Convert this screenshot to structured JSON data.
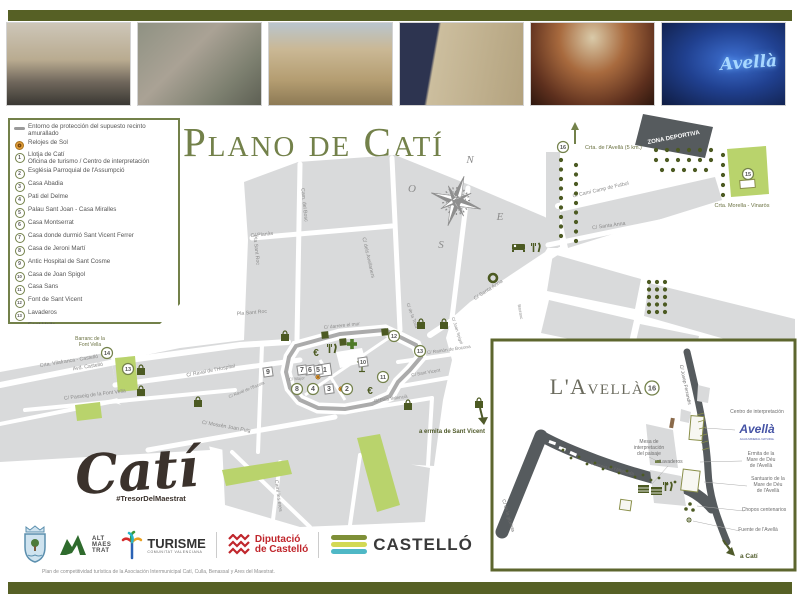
{
  "page": {
    "title": "Plano de Catí"
  },
  "photos": {
    "items": [
      {
        "name": "motorbike-street-photo"
      },
      {
        "name": "couple-fountain-photo"
      },
      {
        "name": "church-facade-photo"
      },
      {
        "name": "palace-facade-photo"
      },
      {
        "name": "fresco-ceiling-photo"
      },
      {
        "name": "avella-museum-photo"
      }
    ],
    "avella_caption": "Avellà"
  },
  "legend": {
    "wall_label": "Entorno de protección del supuesto recinto amurallado",
    "sun_label": "Relojes de Sol",
    "items": [
      {
        "num": "1",
        "label": "Llotja de Catí",
        "label2": "Oficina de turismo / Centro de interpretación"
      },
      {
        "num": "2",
        "label": "Església Parroquial de l'Assumpció"
      },
      {
        "num": "3",
        "label": "Casa Abadia"
      },
      {
        "num": "4",
        "label": "Pati del Delme"
      },
      {
        "num": "5",
        "label": "Palau Sant Joan - Casa Miralles"
      },
      {
        "num": "6",
        "label": "Casa Montserrat"
      },
      {
        "num": "7",
        "label": "Casa donde durmió Sant Vicent Ferrer"
      },
      {
        "num": "8",
        "label": "Casa de Jeroni Martí"
      },
      {
        "num": "9",
        "label": "Antic Hospital de Sant Cosme"
      },
      {
        "num": "10",
        "label": "Casa de Joan Spigol"
      },
      {
        "num": "11",
        "label": "Casa Sans"
      },
      {
        "num": "12",
        "label": "Font de Sant Vicent"
      },
      {
        "num": "13",
        "label": "Lavaderos"
      },
      {
        "num": "14",
        "label": "Font Vella"
      },
      {
        "num": "15",
        "label": "Ermita de Santa Anna"
      },
      {
        "num": "16",
        "label": "L'Avellà"
      }
    ]
  },
  "compass": {
    "n": "N",
    "e": "E",
    "s": "S",
    "w": "O"
  },
  "map": {
    "street_labels": [
      {
        "t": "C/ Planàs",
        "x": 262,
        "y": 236,
        "r": -6
      },
      {
        "t": "Cam. del Bosc",
        "x": 303,
        "y": 205,
        "r": 84
      },
      {
        "t": "Pla Sant Roc",
        "x": 255,
        "y": 250,
        "r": 84
      },
      {
        "t": "Pla Sant Roc",
        "x": 252,
        "y": 314,
        "r": -5
      },
      {
        "t": "C/ dels Avellaners",
        "x": 367,
        "y": 258,
        "r": 77
      },
      {
        "t": "C/ de la Tosa",
        "x": 411,
        "y": 316,
        "r": 70,
        "fs": 4.5
      },
      {
        "t": "C/ darrere el mur",
        "x": 342,
        "y": 327,
        "r": -6,
        "fs": 4.8
      },
      {
        "t": "C/ Santa Anna",
        "x": 609,
        "y": 227,
        "r": -8
      },
      {
        "t": "C/ Santa Anna",
        "x": 489,
        "y": 291,
        "r": -33
      },
      {
        "t": "C/ Camí Camp de Futbol",
        "x": 601,
        "y": 191,
        "r": -13
      },
      {
        "t": "Crta. Vilafranca - Castelló",
        "x": 40,
        "y": 367,
        "r": -9,
        "anchor": "start"
      },
      {
        "t": "Avd. Castelló",
        "x": 88,
        "y": 368,
        "r": -9
      },
      {
        "t": "C/ Passeig de la Font Vella",
        "x": 95,
        "y": 396,
        "r": -7
      },
      {
        "t": "C/ Raval de l'Hospital",
        "x": 211,
        "y": 372,
        "r": -11
      },
      {
        "t": "C/ Raval de l'Escola",
        "x": 247,
        "y": 391,
        "r": -22,
        "fs": 4.3
      },
      {
        "t": "C/ Mossèn Joan Puig",
        "x": 226,
        "y": 428,
        "r": 10
      },
      {
        "t": "C/ Ramón de Bocona",
        "x": 449,
        "y": 351,
        "r": -8,
        "fs": 4.6
      },
      {
        "t": "C/ Sant Vicent",
        "x": 426,
        "y": 374,
        "r": -10,
        "fs": 4.6
      },
      {
        "t": "C/ Major",
        "x": 297,
        "y": 380,
        "r": -5,
        "fs": 4.2
      },
      {
        "t": "C/ País Valencià",
        "x": 391,
        "y": 400,
        "r": -8,
        "fs": 4.6
      },
      {
        "t": "Camí les eres",
        "x": 277,
        "y": 496,
        "r": 82
      },
      {
        "t": "C/ Joan Spigol",
        "x": 456,
        "y": 331,
        "r": 72,
        "fs": 4.3
      },
      {
        "t": "Barranc",
        "x": 519,
        "y": 312,
        "r": 80,
        "fs": 4.3
      },
      {
        "t": "Barranc de la",
        "x": 90,
        "y": 340,
        "fill": "#6b7242",
        "fs": 5
      },
      {
        "t": "Font Vella",
        "x": 90,
        "y": 346,
        "fill": "#6b7242",
        "fs": 5
      }
    ],
    "area_labels": [
      {
        "t": "ZONA DEPORTIVA",
        "x": 674,
        "y": 139,
        "r": -11,
        "fill": "#ffffff",
        "fs": 6,
        "bold": true
      },
      {
        "t": "Crta. Morella - Vinaròs",
        "x": 742,
        "y": 207,
        "fs": 5.5
      },
      {
        "t": "Crta. de l'Avellà (5 km.)",
        "x": 585,
        "y": 149,
        "fs": 5.5,
        "anchor": "start"
      },
      {
        "t": "a ermita de Sant Vicent",
        "x": 452,
        "y": 433,
        "fill": "#4f5a2a",
        "fs": 6,
        "bold": true
      }
    ],
    "markers": [
      {
        "n": "1",
        "x": 325,
        "y": 370,
        "s": "s"
      },
      {
        "n": "2",
        "x": 347,
        "y": 389,
        "s": "c"
      },
      {
        "n": "3",
        "x": 329,
        "y": 389,
        "s": "s"
      },
      {
        "n": "4",
        "x": 313,
        "y": 389,
        "s": "c"
      },
      {
        "n": "5",
        "x": 318,
        "y": 370,
        "s": "s"
      },
      {
        "n": "6",
        "x": 310,
        "y": 370,
        "s": "s"
      },
      {
        "n": "7",
        "x": 302,
        "y": 370,
        "s": "s"
      },
      {
        "n": "8",
        "x": 297,
        "y": 389,
        "s": "c"
      },
      {
        "n": "9",
        "x": 268,
        "y": 372,
        "s": "s"
      },
      {
        "n": "10",
        "x": 363,
        "y": 362,
        "s": "s"
      },
      {
        "n": "11",
        "x": 383,
        "y": 377,
        "s": "c"
      },
      {
        "n": "12",
        "x": 394,
        "y": 336,
        "s": "c"
      },
      {
        "n": "13",
        "x": 420,
        "y": 351,
        "s": "c"
      },
      {
        "n": "13",
        "x": 128,
        "y": 369,
        "s": "c"
      },
      {
        "n": "14",
        "x": 107,
        "y": 353,
        "s": "c"
      },
      {
        "n": "15",
        "x": 748,
        "y": 174,
        "s": "c"
      },
      {
        "n": "16",
        "x": 563,
        "y": 147,
        "s": "c"
      }
    ],
    "icons": [
      {
        "k": "euro",
        "x": 316,
        "y": 352
      },
      {
        "k": "euro",
        "x": 370,
        "y": 390
      },
      {
        "k": "rest",
        "x": 332,
        "y": 344
      },
      {
        "k": "rest",
        "x": 536,
        "y": 243
      },
      {
        "k": "rest",
        "x": 668,
        "y": 482
      },
      {
        "k": "bed",
        "x": 518,
        "y": 244
      },
      {
        "k": "cross",
        "x": 352,
        "y": 344
      },
      {
        "k": "drink",
        "x": 362,
        "y": 366
      },
      {
        "k": "ring",
        "x": 493,
        "y": 278
      },
      {
        "k": "bag",
        "x": 285,
        "y": 337
      },
      {
        "k": "bag",
        "x": 421,
        "y": 325
      },
      {
        "k": "bag",
        "x": 444,
        "y": 325
      },
      {
        "k": "bag",
        "x": 141,
        "y": 371
      },
      {
        "k": "bag",
        "x": 141,
        "y": 392
      },
      {
        "k": "bag",
        "x": 408,
        "y": 406
      },
      {
        "k": "bag",
        "x": 479,
        "y": 404
      },
      {
        "k": "bag",
        "x": 198,
        "y": 403
      },
      {
        "k": "sun",
        "x": 318,
        "y": 377
      },
      {
        "k": "sun",
        "x": 331,
        "y": 391
      },
      {
        "k": "sun",
        "x": 341,
        "y": 389
      },
      {
        "k": "bldg",
        "x": 325,
        "y": 335
      },
      {
        "k": "bldg",
        "x": 343,
        "y": 342
      },
      {
        "k": "bldg",
        "x": 385,
        "y": 332
      }
    ],
    "tree_clusters": [
      {
        "x": 561,
        "y": 160,
        "cols": 1,
        "rows": 9,
        "dx": 0,
        "dy": 9.5
      },
      {
        "x": 576,
        "y": 165,
        "cols": 1,
        "rows": 9,
        "dx": 0,
        "dy": 9.5
      },
      {
        "x": 656,
        "y": 150,
        "cols": 6,
        "rows": 2,
        "dx": 11,
        "dy": 10
      },
      {
        "x": 662,
        "y": 170,
        "cols": 5,
        "rows": 1,
        "dx": 11,
        "dy": 10
      },
      {
        "x": 723,
        "y": 155,
        "cols": 1,
        "rows": 5,
        "dx": 0,
        "dy": 10
      },
      {
        "x": 649,
        "y": 282,
        "cols": 3,
        "rows": 5,
        "dx": 8,
        "dy": 7.5
      }
    ]
  },
  "inset": {
    "title": "L'Avellà",
    "num": "16",
    "logo": {
      "script": "Avellà",
      "caption": "AGUA MINERAL NATURAL"
    },
    "labels": [
      {
        "t": "C/ Josep Ferrandis",
        "x": 684,
        "y": 385,
        "r": 78,
        "fs": 4.8
      },
      {
        "t": "Centro de interpretación",
        "x": 757,
        "y": 413
      },
      {
        "t": "Ermita de la",
        "x": 761,
        "y": 455
      },
      {
        "t": "Mare de Déu",
        "x": 761,
        "y": 461
      },
      {
        "t": "de l'Avellà",
        "x": 761,
        "y": 467
      },
      {
        "t": "Santuario de la",
        "x": 768,
        "y": 480
      },
      {
        "t": "Mare de Déu",
        "x": 768,
        "y": 486
      },
      {
        "t": "de l'Avellà",
        "x": 768,
        "y": 492
      },
      {
        "t": "Chopos centenarios",
        "x": 764,
        "y": 511
      },
      {
        "t": "Fuente de l'Avellà",
        "x": 758,
        "y": 531
      },
      {
        "t": "Mesa de",
        "x": 649,
        "y": 443
      },
      {
        "t": "interpretación",
        "x": 649,
        "y": 449
      },
      {
        "t": "del paisaje",
        "x": 649,
        "y": 455
      },
      {
        "t": "Lavaderos",
        "x": 671,
        "y": 463
      },
      {
        "t": "Passeig de l'Albereda",
        "x": 612,
        "y": 470,
        "r": 14,
        "fs": 4.6
      },
      {
        "t": "C/ de la glorieta",
        "x": 507,
        "y": 516,
        "r": 73,
        "fs": 4.8
      },
      {
        "t": "a Catí",
        "x": 740,
        "y": 558,
        "fs": 6.5,
        "fill": "#4f5a2a",
        "bold": true,
        "anchor": "start"
      }
    ],
    "tree_dots": [
      [
        563,
        452
      ],
      [
        571,
        456
      ],
      [
        579,
        459
      ],
      [
        587,
        462
      ],
      [
        595,
        465
      ],
      [
        603,
        467
      ],
      [
        611,
        469
      ],
      [
        619,
        471
      ],
      [
        627,
        473
      ],
      [
        635,
        475
      ],
      [
        643,
        477
      ],
      [
        651,
        478
      ],
      [
        659,
        480
      ],
      [
        667,
        482
      ],
      [
        675,
        484
      ]
    ]
  },
  "branding": {
    "cati": "Catí",
    "hashtag": "#TresorDelMaestrat"
  },
  "footer": {
    "note": "Plan de competitividad turística de la Asociación Intermunicipal Catí, Culla, Benassal y Ares del Maestrat.",
    "logos": {
      "alt_lines": [
        "ALT",
        "MAES",
        "TRAT"
      ],
      "turisme": "TURISME",
      "turisme_sub": "COMUNITAT VALENCIANA",
      "dipu1": "Diputació",
      "dipu2": "de Castelló",
      "castello": "CASTELLÓ"
    }
  }
}
